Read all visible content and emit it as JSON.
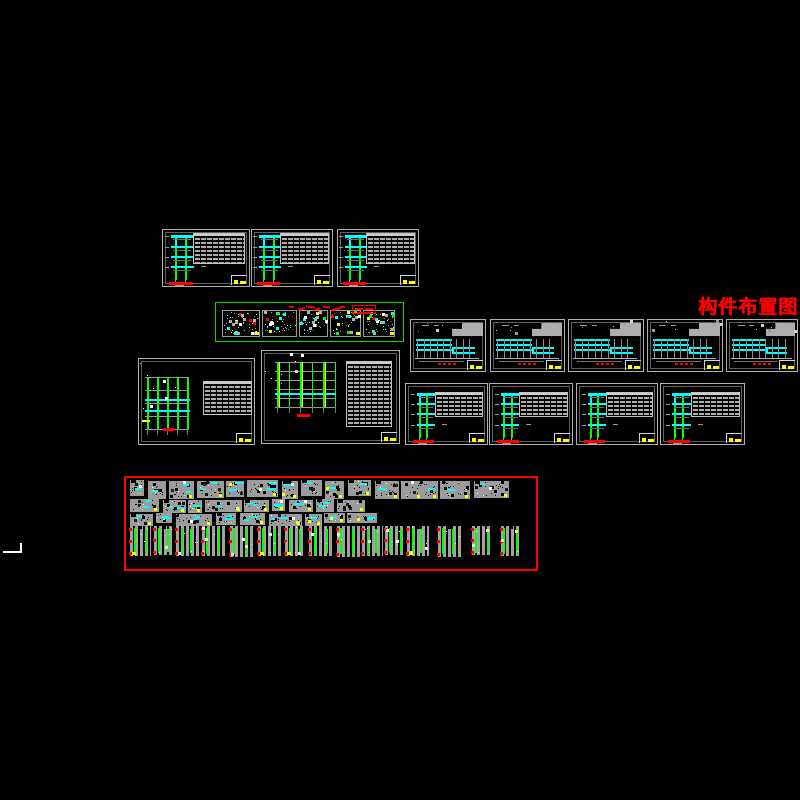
{
  "canvas": {
    "background": "#000000",
    "description": "CAD model space, black background, clusters of structural drawing sheets"
  },
  "palette": {
    "frame": "#b0b0b0",
    "dim": "#8c8c8c",
    "cyan": "#00ffff",
    "green": "#00ff00",
    "red": "#ff0000",
    "yellow": "#ffff00",
    "white": "#ffffff",
    "panel": "#9c9c9c"
  },
  "titles": {
    "layout_title": "构件布置图",
    "fabrication_title": "构件加工图"
  },
  "groups": {
    "top_elevation_sheets": {
      "count": 3
    },
    "green_detail_sheet": {
      "panel_widths": [
        38,
        35,
        29,
        31,
        32
      ]
    },
    "stepped_elevation_sheets": {
      "count": 5
    },
    "grid_plan_sheets": {
      "count": 2
    },
    "mid_elevation_sheets": {
      "count": 4
    },
    "fabrication_area": {
      "bands": [
        {
          "kind": "beam-detail-panels",
          "count": 14,
          "x_end": 402,
          "y": 3,
          "h": 17
        },
        {
          "kind": "beam-detail-panels",
          "count": 11,
          "x_end": 268,
          "y": 22,
          "h": 12
        },
        {
          "kind": "beam-detail-panels",
          "count": 9,
          "x_end": 258,
          "y": 36,
          "h": 11
        },
        {
          "kind": "column-detail-strips",
          "count": 15,
          "x_end": 408,
          "y": 48,
          "h": 31
        }
      ]
    }
  }
}
